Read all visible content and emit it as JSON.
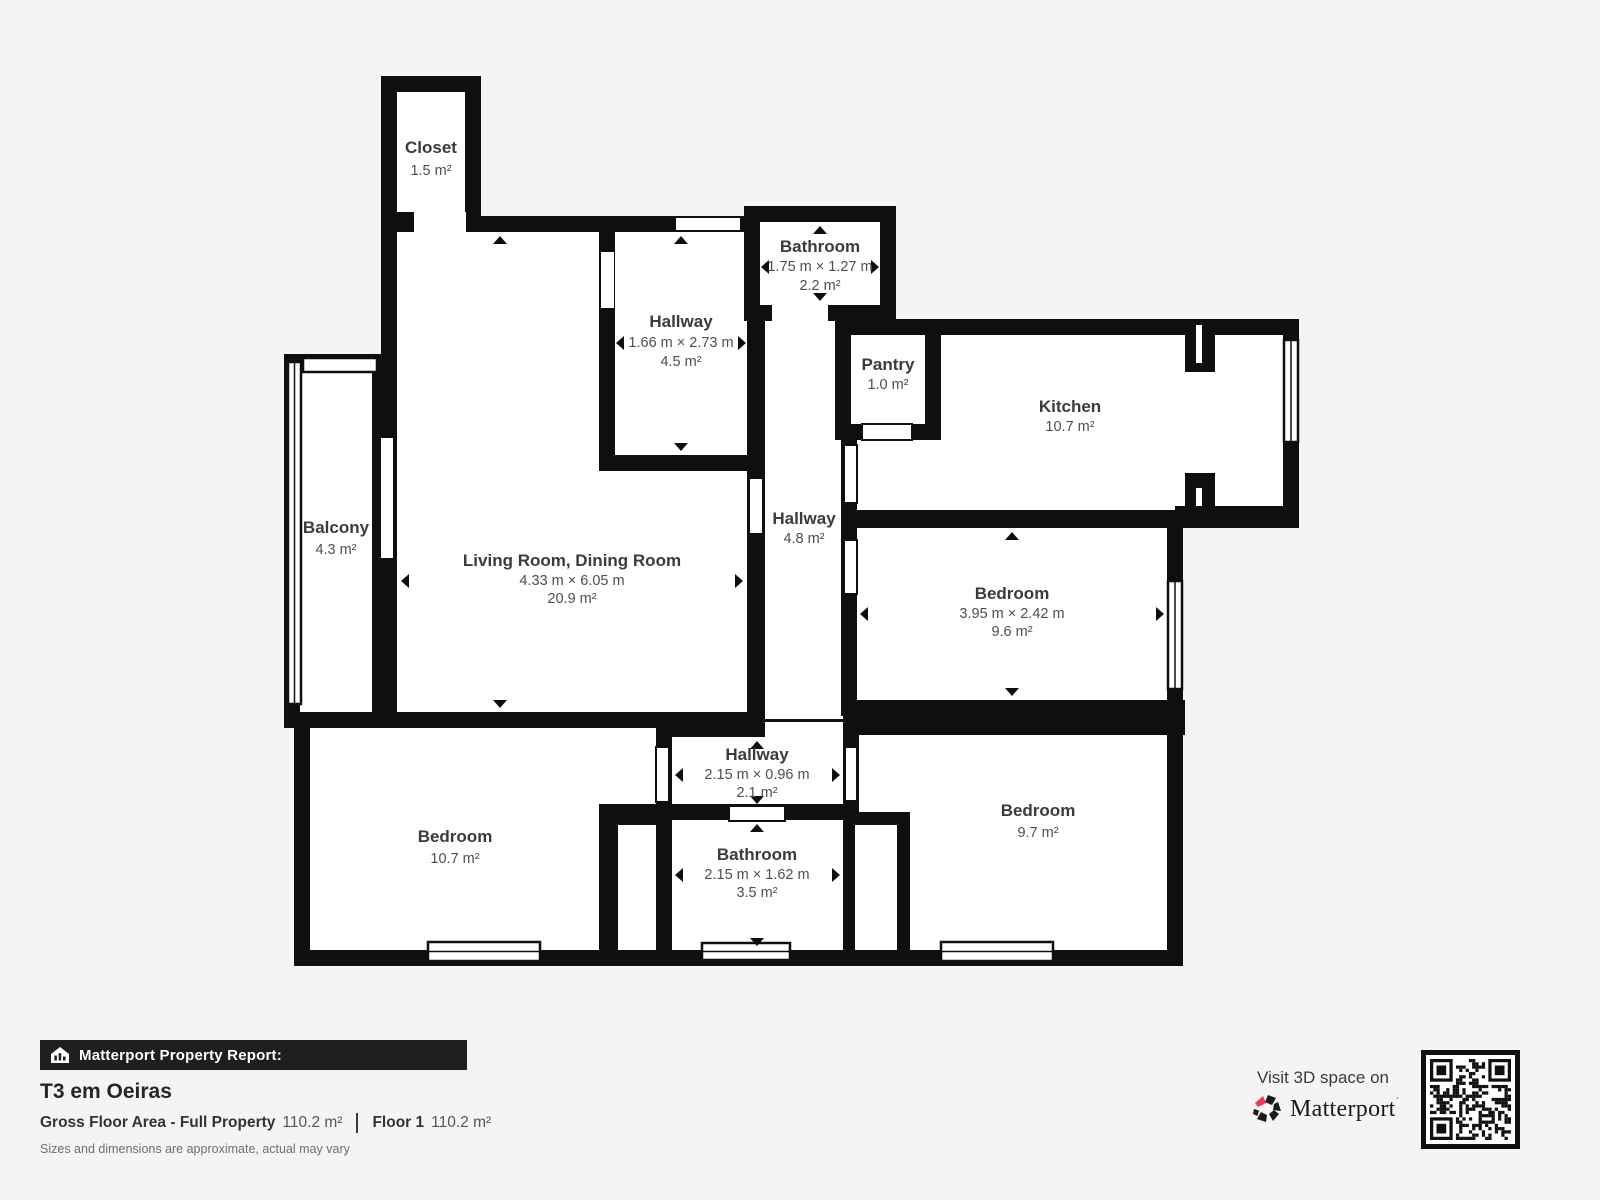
{
  "floorplan": {
    "rooms": {
      "closet": {
        "name": "Closet",
        "area": "1.5 m²"
      },
      "hallway_top": {
        "name": "Hallway",
        "dims": "1.66 m × 2.73 m",
        "area": "4.5 m²"
      },
      "bathroom_top": {
        "name": "Bathroom",
        "dims": "1.75 m × 1.27 m",
        "area": "2.2 m²"
      },
      "pantry": {
        "name": "Pantry",
        "area": "1.0 m²"
      },
      "kitchen": {
        "name": "Kitchen",
        "area": "10.7 m²"
      },
      "balcony": {
        "name": "Balcony",
        "area": "4.3 m²"
      },
      "living_room": {
        "name": "Living Room, Dining Room",
        "dims": "4.33 m × 6.05 m",
        "area": "20.9 m²"
      },
      "hallway_center": {
        "name": "Hallway",
        "area": "4.8 m²"
      },
      "bedroom_right": {
        "name": "Bedroom",
        "dims": "3.95 m × 2.42 m",
        "area": "9.6 m²"
      },
      "bedroom_left": {
        "name": "Bedroom",
        "area": "10.7 m²"
      },
      "hallway_bottom": {
        "name": "Hallway",
        "dims": "2.15 m × 0.96 m",
        "area": "2.1 m²"
      },
      "bathroom_bottom": {
        "name": "Bathroom",
        "dims": "2.15 m × 1.62 m",
        "area": "3.5 m²"
      },
      "bedroom_bottom_right": {
        "name": "Bedroom",
        "area": "9.7 m²"
      }
    }
  },
  "footer": {
    "report_label": "Matterport Property Report:",
    "property_title": "T3 em Oeiras",
    "gross_floor_area_label": "Gross Floor Area - Full Property",
    "gross_floor_area_value": "110.2 m²",
    "floor_label": "Floor 1",
    "floor_value": "110.2 m²",
    "disclaimer": "Sizes and dimensions are approximate, actual may vary",
    "visit_label": "Visit 3D space on",
    "brand": "Matterport"
  },
  "colors": {
    "background": "#f5f4f2",
    "wall": "#0f0f0f",
    "brand_red": "#f4385c",
    "footer_bar": "#1f1f1f"
  }
}
